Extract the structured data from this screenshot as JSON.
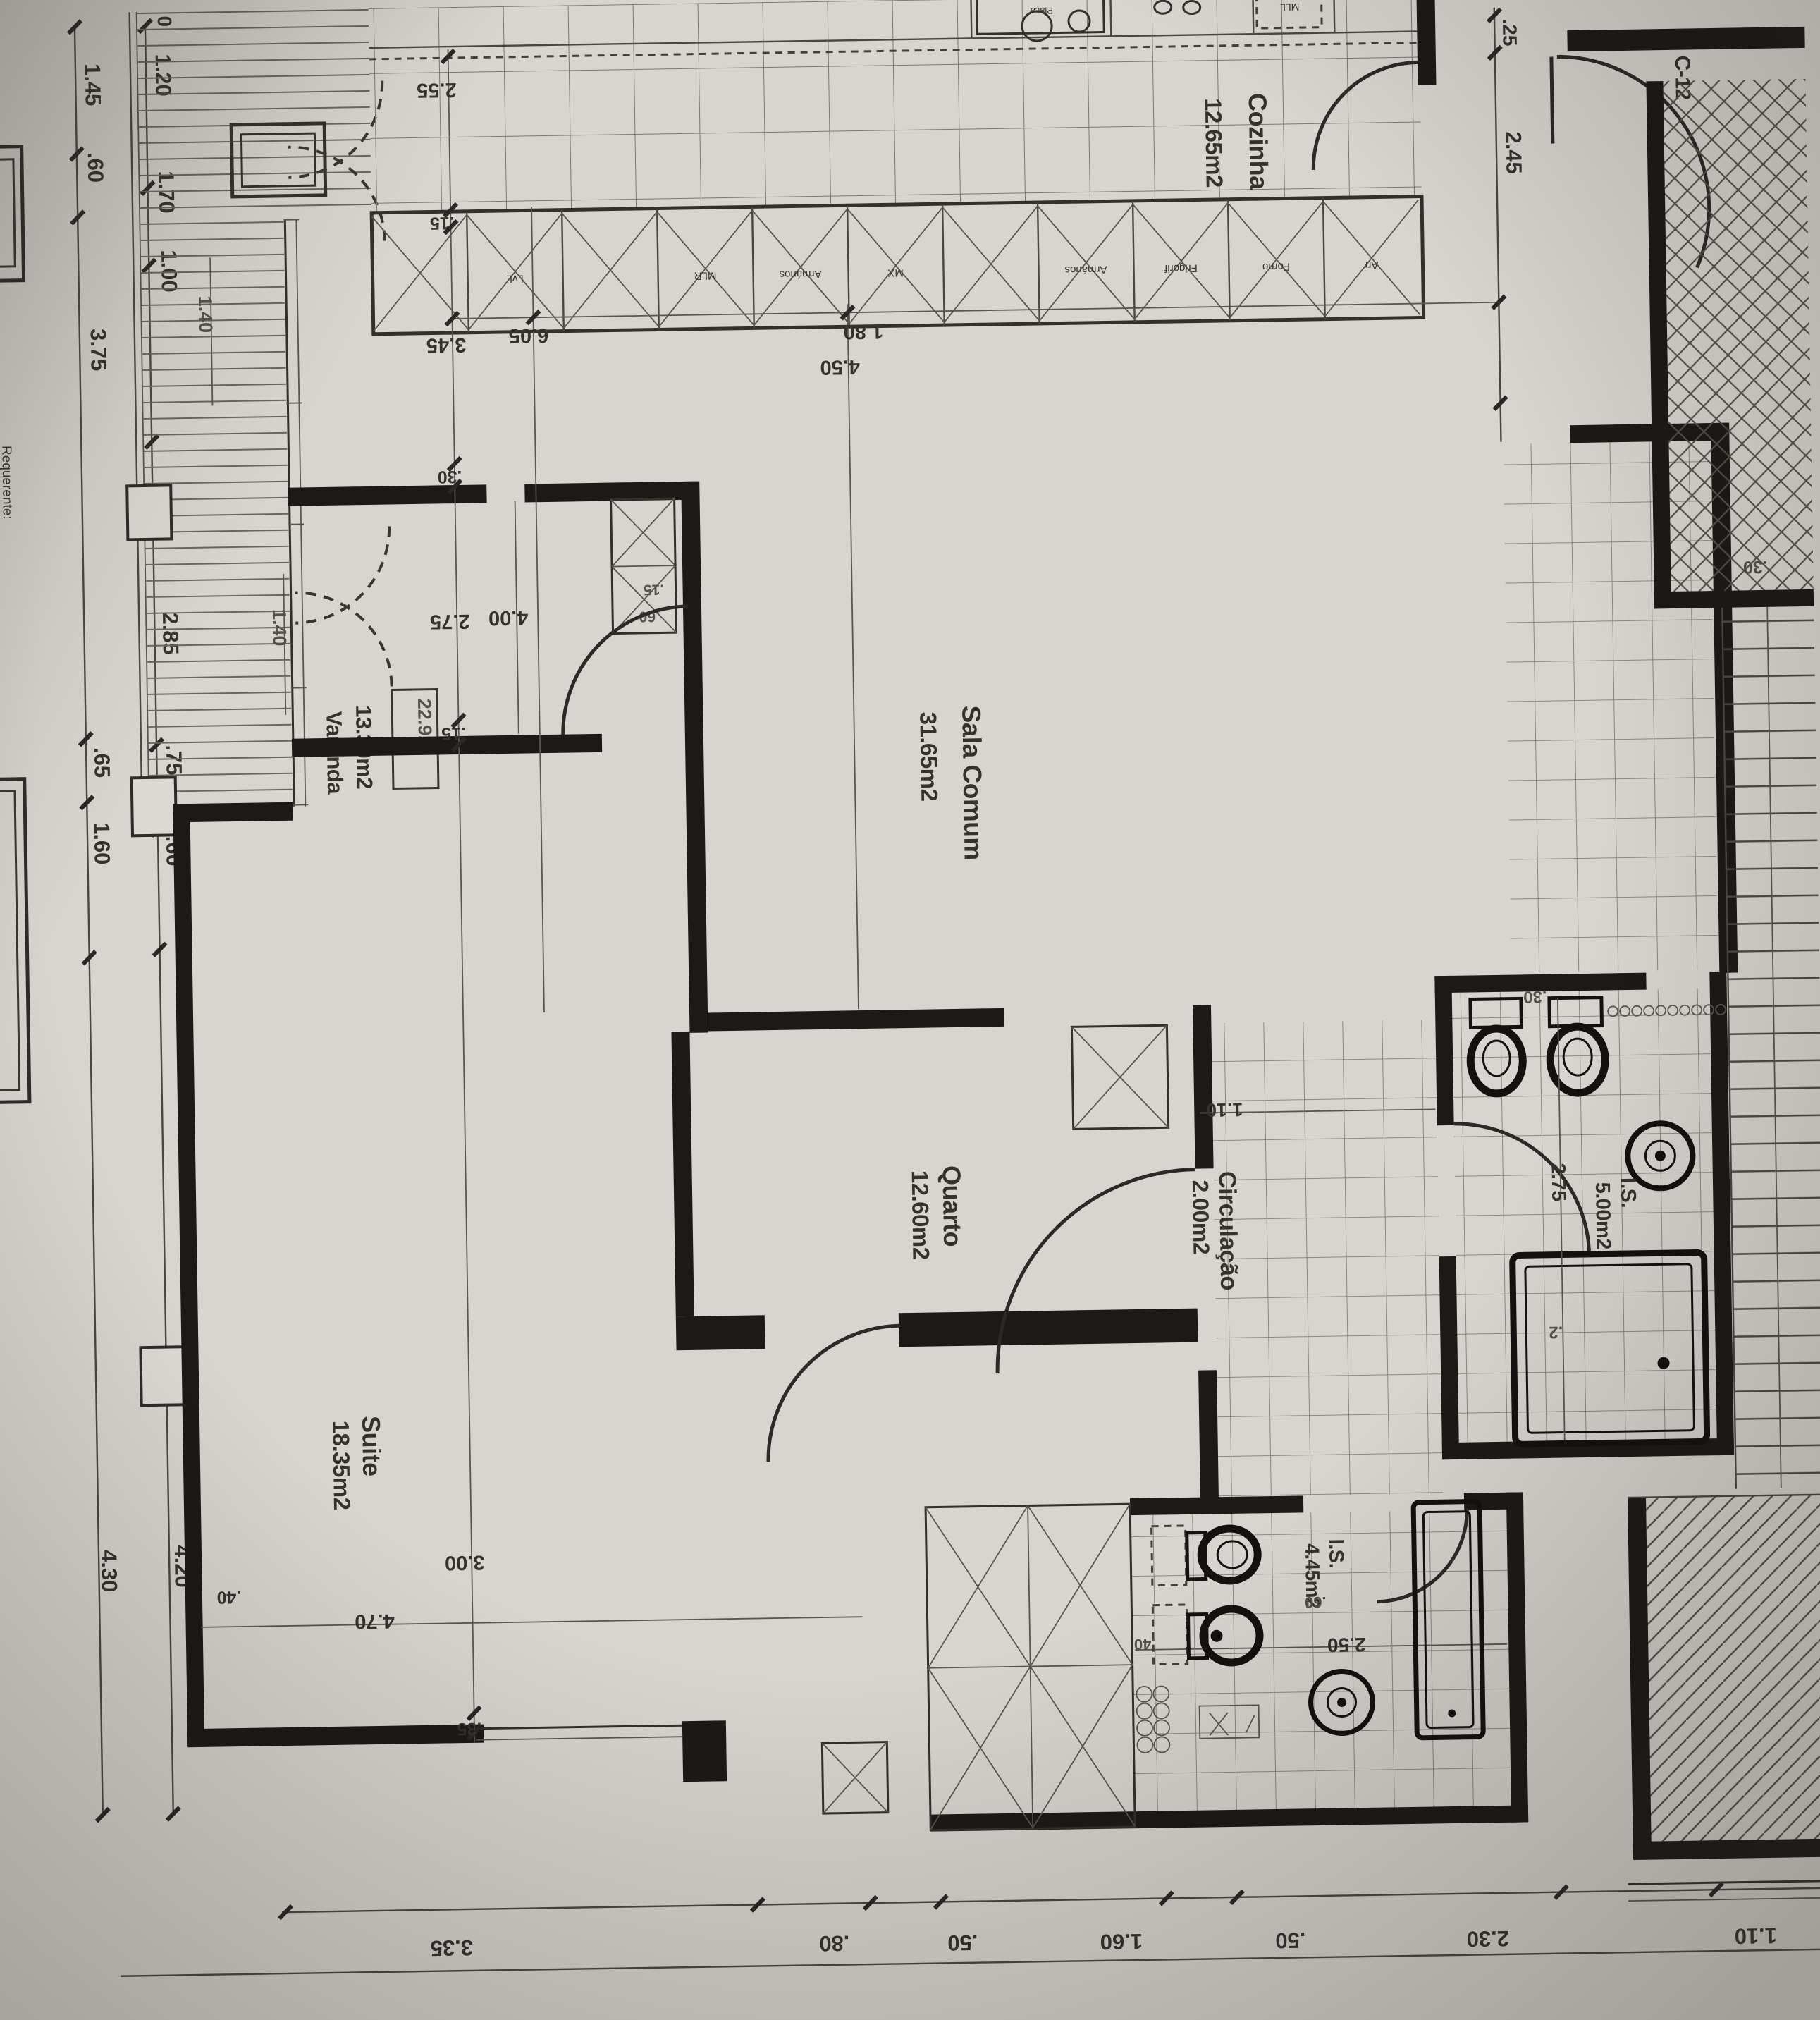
{
  "colors": {
    "paper": "#d8d5cf",
    "ink": "#3a3734",
    "wall": "#1d1a17"
  },
  "sheet": {
    "requerente": "Requerente:",
    "unit": "C-12",
    "level": "22.92"
  },
  "rooms": {
    "sala": {
      "name": "Sala Comum",
      "area": "31.65m2"
    },
    "cozinha": {
      "name": "Cozinha",
      "area": "12.65m2"
    },
    "quarto": {
      "name": "Quarto",
      "area": "12.60m2"
    },
    "suite": {
      "name": "Suite",
      "area": "18.35m2"
    },
    "circulacao": {
      "name": "Circulação",
      "area": "2.00m2"
    },
    "varanda": {
      "name": "Varanda",
      "area": "13.30m2"
    },
    "is1": {
      "name": "I.S.",
      "area": "5.00m2"
    },
    "is2": {
      "name": "I.S.",
      "area": "4.45m2"
    }
  },
  "kitchen": {
    "top_units": {
      "placa": "Placa",
      "mll": "MLL"
    },
    "units": {
      "u1": "LvL",
      "u2": "MLR",
      "u3": "Armários",
      "u4": "MX",
      "u5": "Armários",
      "u6": "Frigorif",
      "u7": "Forno",
      "u8": "Arr"
    }
  },
  "dims": {
    "left_outer": {
      "d1": "1.45",
      "d2": ".60",
      "d3": "3.75",
      "d4": ".65",
      "d5": "1.60",
      "d6": "4.30"
    },
    "left_inner": {
      "d0": "0",
      "d1": "1.20",
      "d2": "1.70",
      "d3": "1.00",
      "d4": "2.85",
      "d5": ".75",
      "d6": "1.60",
      "d7": "4.20"
    },
    "entry": {
      "d1": ".25",
      "d2": "2.45"
    },
    "sala": {
      "d1": "2.55",
      "d2": ".15",
      "d3": "3.45",
      "d4": ".30",
      "d5": "6.05",
      "d6": "4.50",
      "d7": "1.80",
      "d8": ".30"
    },
    "quarto": {
      "d1": "2.75",
      "d2": "4.00",
      "d3": ".15",
      "d4": ".15",
      "d5": ".60"
    },
    "suite": {
      "d1": "3.00",
      "d2": "4.70",
      "d3": ".35",
      "d4": ".40"
    },
    "varanda": {
      "d1": "1.40",
      "d2": "1.40"
    },
    "hall": {
      "d1": "1.10"
    },
    "bath1": {
      "d1": "2.75",
      "d2": ".30",
      "d3": ".2"
    },
    "bath2": {
      "d1": "2.50",
      "d2": ".60",
      "d3": ".40"
    },
    "bottom": {
      "d1": "3.35",
      "d2": ".80",
      "d3": ".50",
      "d4": "1.60",
      "d5": ".50",
      "d6": "2.30",
      "d7": "1.10"
    }
  }
}
